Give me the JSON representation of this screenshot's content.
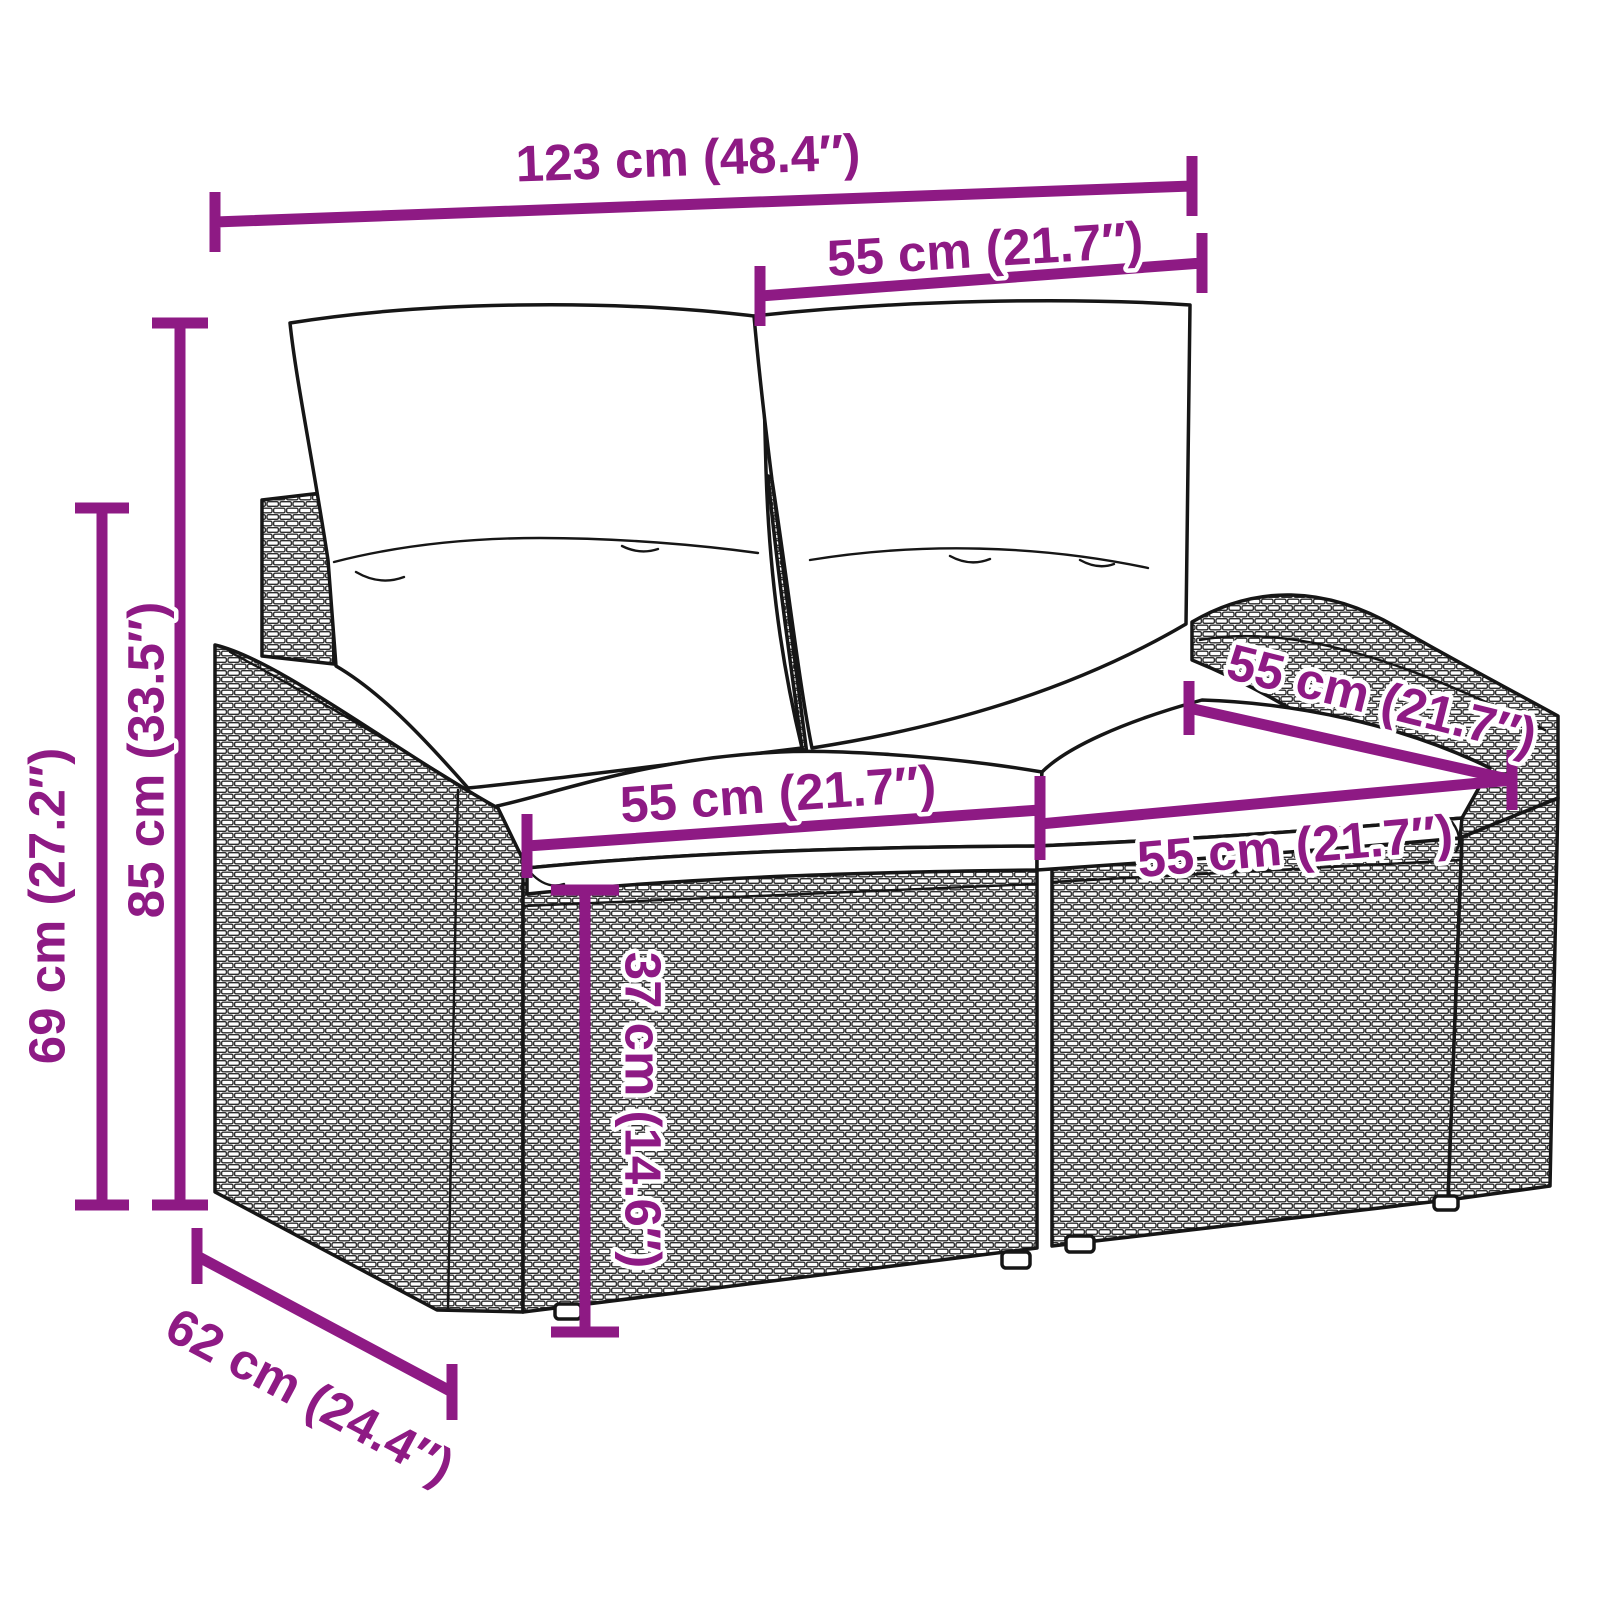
{
  "diagram": {
    "kind": "product-dimension-diagram",
    "subject": "poly-rattan-2-seater-garden-sofa-with-cushions",
    "colors": {
      "dimension_accent": "#8E1A84",
      "line_art": "#161616",
      "background": "#FFFFFF",
      "cushions": "#FFFFFF"
    }
  },
  "dimensions": {
    "overall_width": "123 cm (48.4″)",
    "back_cushion_width": "55 cm (21.7″)",
    "seat_depth": "55 cm (21.7″)",
    "seat_width_left": "55 cm (21.7″)",
    "seat_width_right": "55 cm (21.7″)",
    "total_height": "85 cm (33.5″)",
    "frame_height": "69 cm (27.2″)",
    "seat_height": "37 cm (14.6″)",
    "depth": "62 cm (24.4″)"
  }
}
